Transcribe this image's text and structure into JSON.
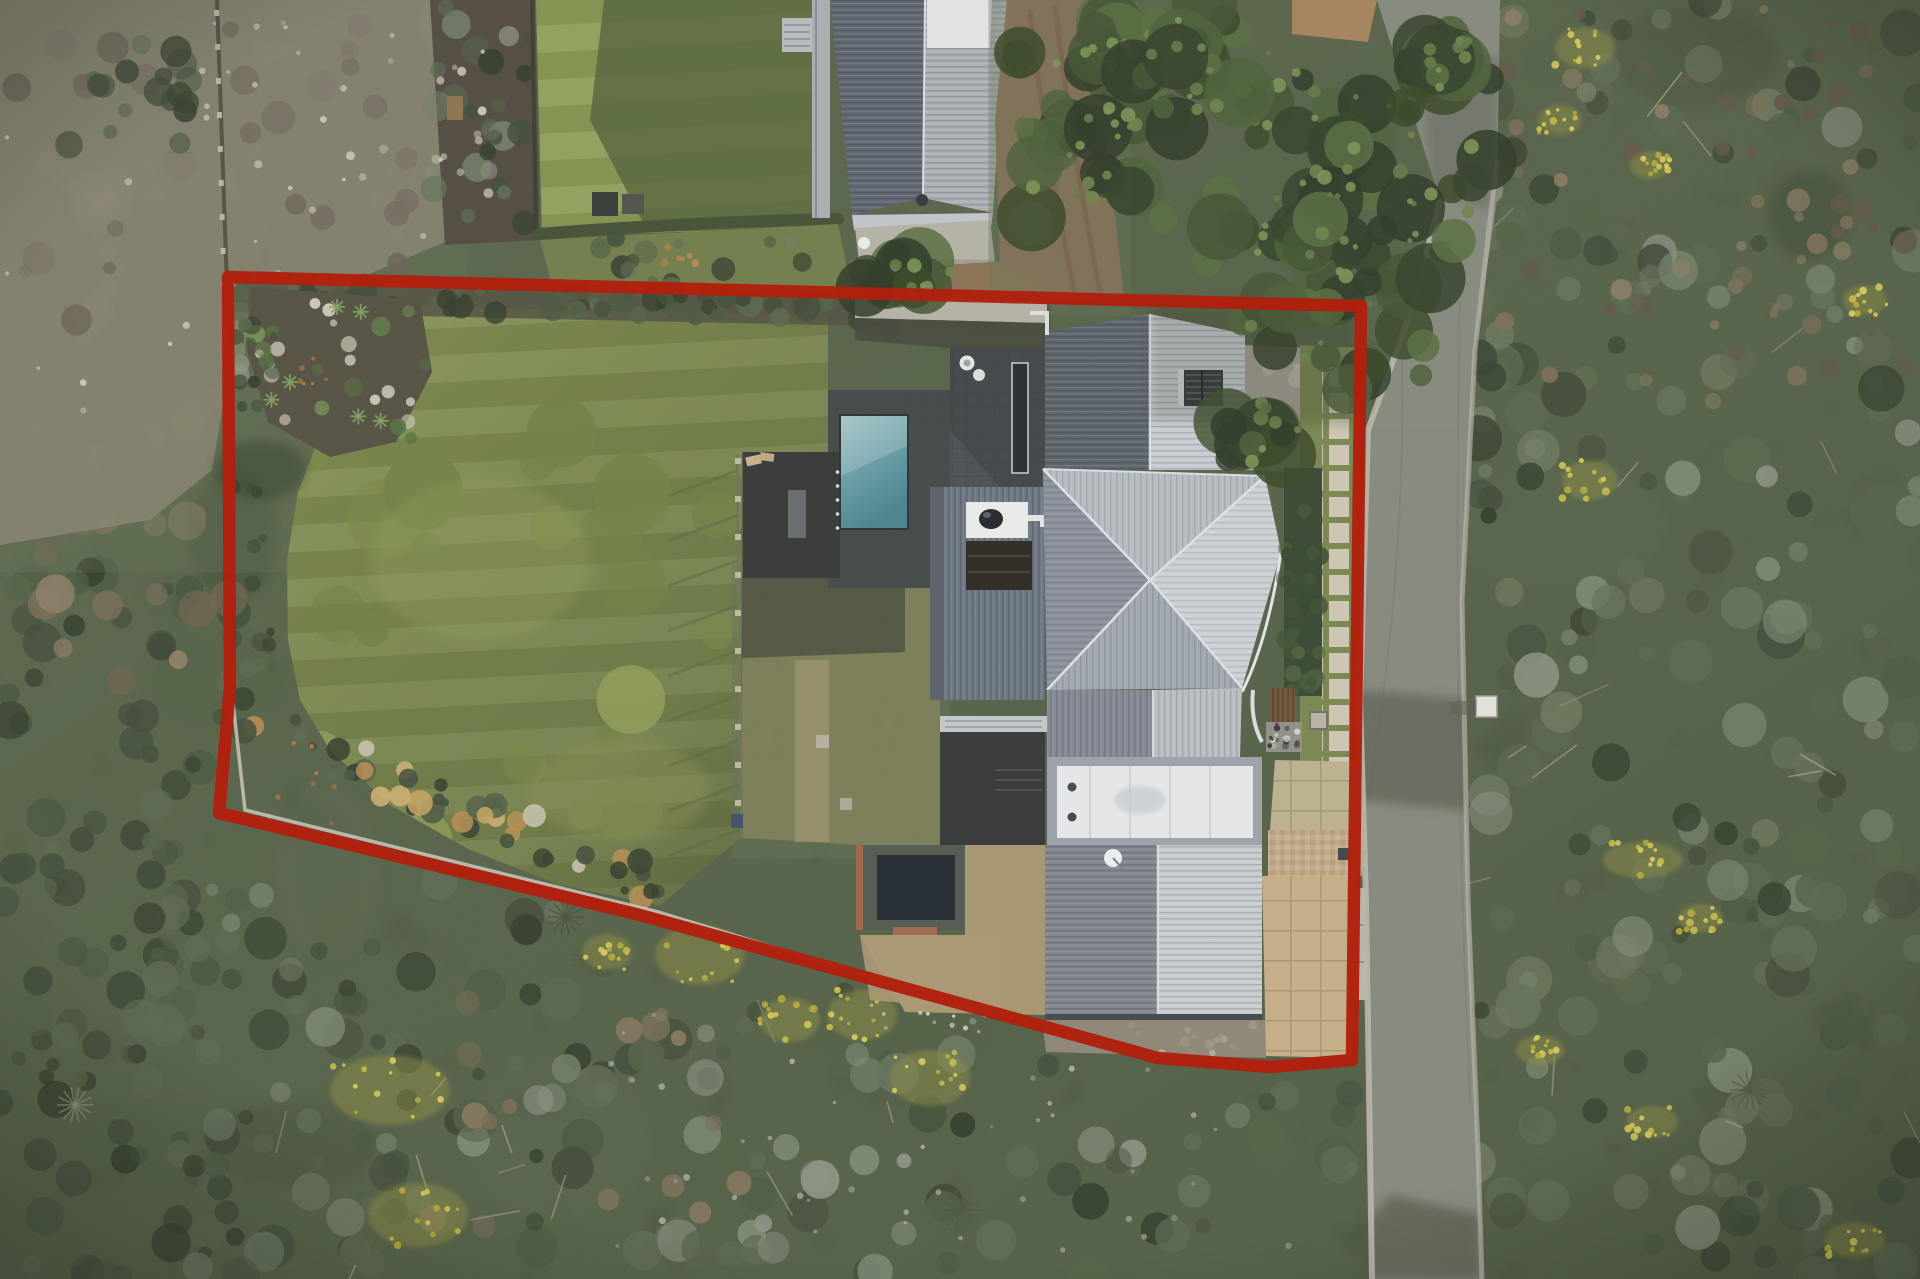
{
  "meta": {
    "kind": "aerial-drone-photograph",
    "subject": "residential property with red cadastral boundary overlay",
    "width_px": 1920,
    "height_px": 1279
  },
  "boundary": {
    "color": "#b1200d",
    "stroke_width": 12.5,
    "opacity": 0.97,
    "points": [
      [
        228,
        277
      ],
      [
        1361,
        306
      ],
      [
        1352,
        1060
      ],
      [
        1270,
        1067
      ],
      [
        1158,
        1058
      ],
      [
        640,
        915
      ],
      [
        219,
        813
      ],
      [
        230,
        687
      ]
    ]
  },
  "palette": {
    "scrub_dark": "#36422c",
    "scrub_mid": "#46523a",
    "rock_ground": "#8f8474",
    "lawn": "#82914b",
    "lawn_shade": "#5d6c3c",
    "lawn_neighbor": "#87994d",
    "road": "#8e8e8a",
    "curb": "#bab6ab",
    "roof_light": "#c9ced4",
    "roof_mid": "#9fa6b0",
    "roof_dark": "#59616c",
    "roof_white": "#e9ebee",
    "pool_teal": "#5d96a0",
    "pool_dark": "#1b212b",
    "deck": "#2e3031",
    "sand": "#c8ad85",
    "paver": "#cfc8b4",
    "brick": "#9c6e50",
    "soil": "#4a443a"
  },
  "scene": {
    "features": [
      "native bushland scrub",
      "rocky vacant lot",
      "neighbouring house with grey gable roof",
      "neighbour lawn with cast shadow",
      "brick patio",
      "gravel driveway",
      "subject lawn",
      "rock garden with agaves",
      "boundary hedge",
      "timber pool deck",
      "teal lap pool",
      "tiled roof terrace with flues",
      "main pavilion hip roof",
      "roof louvre vent",
      "white chimney with cowl",
      "flat white membrane roof",
      "garage gable roof",
      "satellite dish",
      "dark plunge pool",
      "sandy grid-paver courtyard",
      "stepping paver path",
      "asphalt street",
      "roadside utility box",
      "large overhanging trees",
      "yellow flowering gorse"
    ]
  }
}
